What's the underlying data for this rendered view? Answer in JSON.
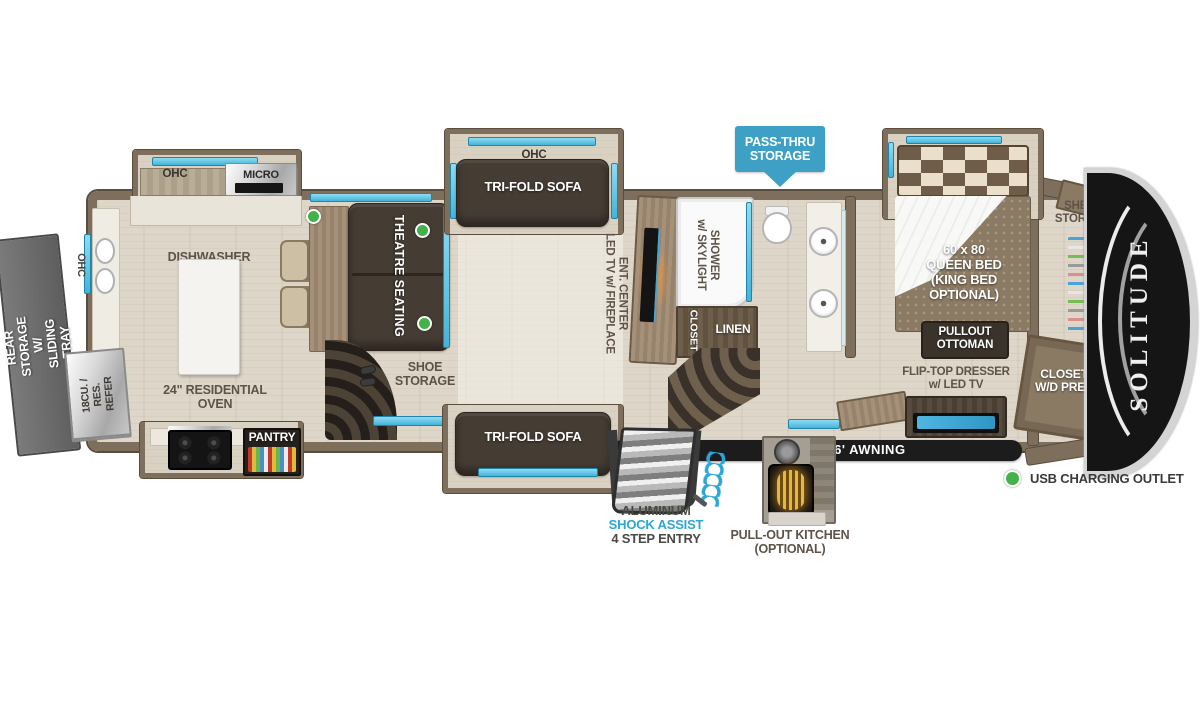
{
  "brand": {
    "logo": "SOLITUDE"
  },
  "banner": {
    "text": "PASS-THRU\nSTORAGE"
  },
  "legend": {
    "usb": "USB CHARGING OUTLET"
  },
  "entry": {
    "line1": "ALUMINUM",
    "line2": "SHOCK ASSIST",
    "line3": "4 STEP ENTRY"
  },
  "labels": {
    "rear_storage": "REAR STORAGE\nW/ SLIDING TRAY",
    "ohc_rear": "OHC",
    "refer": "18CU. / RES.\nREFER",
    "ohc_kitchen": "OHC",
    "micro": "MICRO",
    "dishwasher_prep": "DISHWASHER\nPREP",
    "residential_oven": "24\" RESIDENTIAL\nOVEN",
    "pantry": "PANTRY",
    "theatre_seating": "THEATRE SEATING",
    "shoe_storage": "SHOE\nSTORAGE",
    "ohc_sofa": "OHC",
    "trifold_sofa_top": "TRI-FOLD SOFA",
    "trifold_sofa_bottom": "TRI-FOLD SOFA",
    "ent_center": "ENT. CENTER\nLED TV w/ FIREPLACE",
    "shower": "SHOWER\nw/ SKYLIGHT",
    "closet": "CLOSET",
    "linen": "LINEN",
    "queen_bed": "60 x 80\nQUEEN BED\n(KING BED\nOPTIONAL)",
    "pullout_ottoman": "PULLOUT\nOTTOMAN",
    "shelf_storage": "SHELF\nSTORAGE",
    "flip_top_dresser": "FLIP-TOP DRESSER\nw/ LED TV",
    "closet_wd_prep": "CLOSET\nW/D PREP",
    "awning": "16'  AWNING",
    "pullout_kitchen": "PULL-OUT KITCHEN\n(OPTIONAL)"
  },
  "colors": {
    "wall_taupe": "#7e6f5d",
    "window_blue": "#5ec7e8",
    "banner_blue": "#3fa0c5",
    "usb_green": "#44b24a",
    "shock_assist_blue": "#2aa7d8",
    "label_gray": "#5d5348",
    "awning_black": "#1c1c1c"
  }
}
